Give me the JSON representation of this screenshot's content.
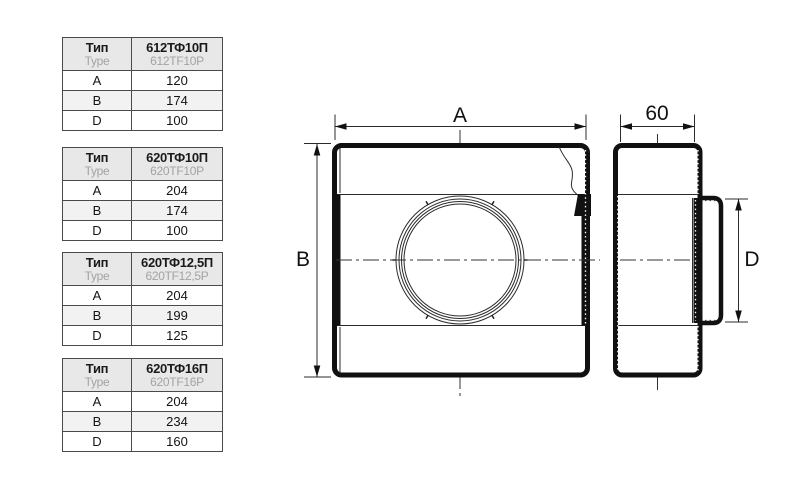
{
  "labels": {
    "type_ru": "Тип",
    "type_en": "Type",
    "dim_a": "A",
    "dim_b": "B",
    "dim_d": "D"
  },
  "tables": [
    {
      "model_ru": "612ТФ10П",
      "model_en": "612TF10P",
      "a": "120",
      "b": "174",
      "d": "100"
    },
    {
      "model_ru": "620ТФ10П",
      "model_en": "620TF10P",
      "a": "204",
      "b": "174",
      "d": "100"
    },
    {
      "model_ru": "620ТФ12,5П",
      "model_en": "620TF12,5P",
      "a": "204",
      "b": "199",
      "d": "125"
    },
    {
      "model_ru": "620ТФ16П",
      "model_en": "620TF16P",
      "a": "204",
      "b": "234",
      "d": "160"
    }
  ],
  "drawing": {
    "front_width_label": "A",
    "front_height_label": "B",
    "side_depth_label": "60",
    "spigot_diameter_label": "D"
  },
  "colors": {
    "background": "#ffffff",
    "line": "#111111",
    "muted_text": "#a3a3a3",
    "table_border": "#4a4a4a",
    "header_bg": "#e8e8e8",
    "alt_row_bg": "#f2f2f2"
  }
}
